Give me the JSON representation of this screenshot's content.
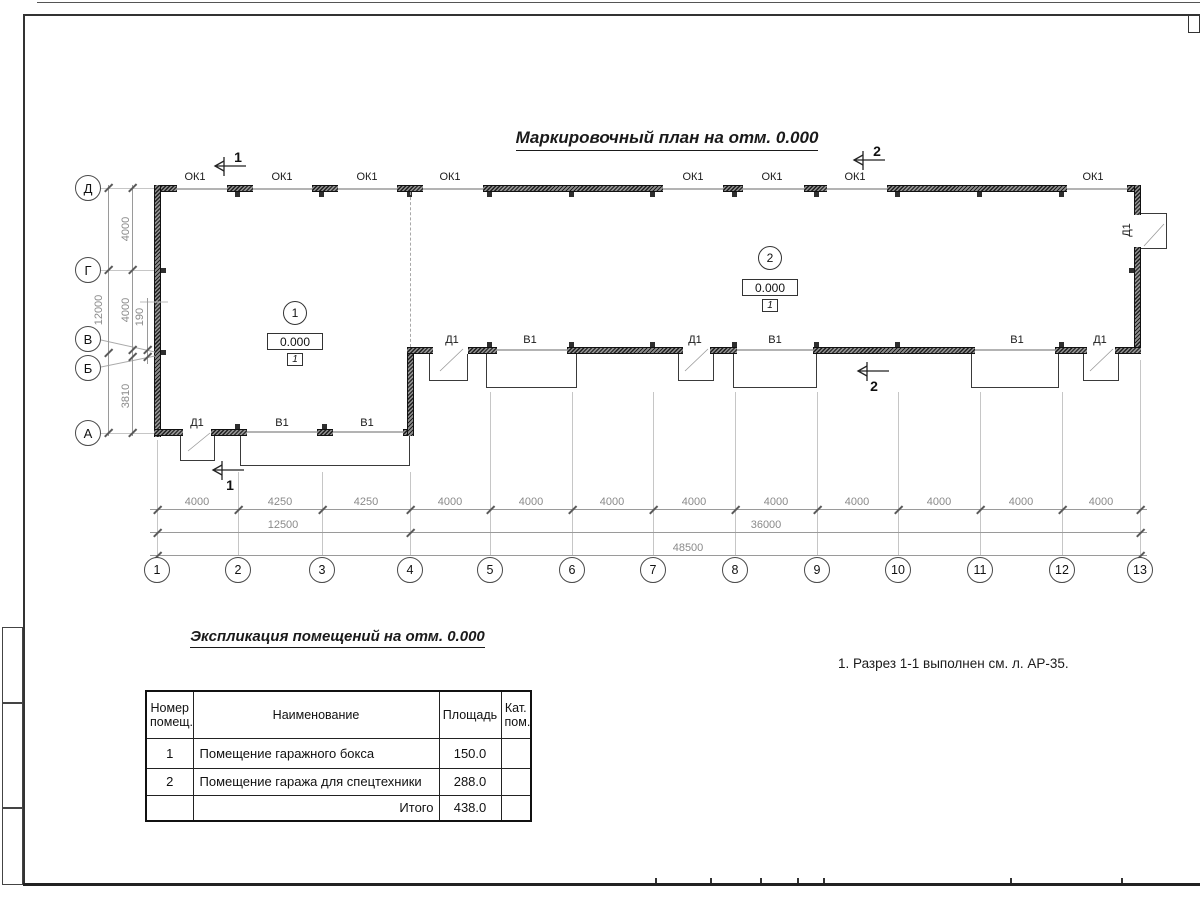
{
  "sheet": {
    "title": "Маркировочный план на отм. 0.000",
    "note": "1. Разрез 1-1 выполнен см. л. АР-35."
  },
  "plan": {
    "window_mark": "ОК1",
    "door_mark": "Д1",
    "gate_mark": "В1",
    "rooms": [
      {
        "number": "1",
        "elevation": "0.000",
        "floor_type": "1"
      },
      {
        "number": "2",
        "elevation": "0.000",
        "floor_type": "1"
      }
    ],
    "sections": {
      "s1": "1",
      "s2": "2"
    },
    "axes_rows": [
      "Д",
      "Г",
      "В",
      "Б",
      "А"
    ],
    "columns": [
      "1",
      "2",
      "3",
      "4",
      "5",
      "6",
      "7",
      "8",
      "9",
      "10",
      "11",
      "12",
      "13"
    ],
    "dims": {
      "bays": [
        "4000",
        "4250",
        "4250",
        "4000",
        "4000",
        "4000",
        "4000",
        "4000",
        "4000",
        "4000",
        "4000",
        "4000"
      ],
      "group_left": "12500",
      "group_right": "36000",
      "total": "48500",
      "left_bays": [
        "4000",
        "4000",
        "190",
        "3810"
      ],
      "left_total": "12000"
    }
  },
  "table": {
    "title": "Экспликация помещений на отм. 0.000",
    "headers": [
      "Номер помещ.",
      "Наименование",
      "Площадь",
      "Кат. пом."
    ],
    "rows": [
      {
        "num": "1",
        "name": "Помещение гаражного бокса",
        "area": "150.0",
        "cat": ""
      },
      {
        "num": "2",
        "name": "Помещение гаража для спецтехники",
        "area": "288.0",
        "cat": ""
      }
    ],
    "total_label": "Итого",
    "total_value": "438.0"
  }
}
